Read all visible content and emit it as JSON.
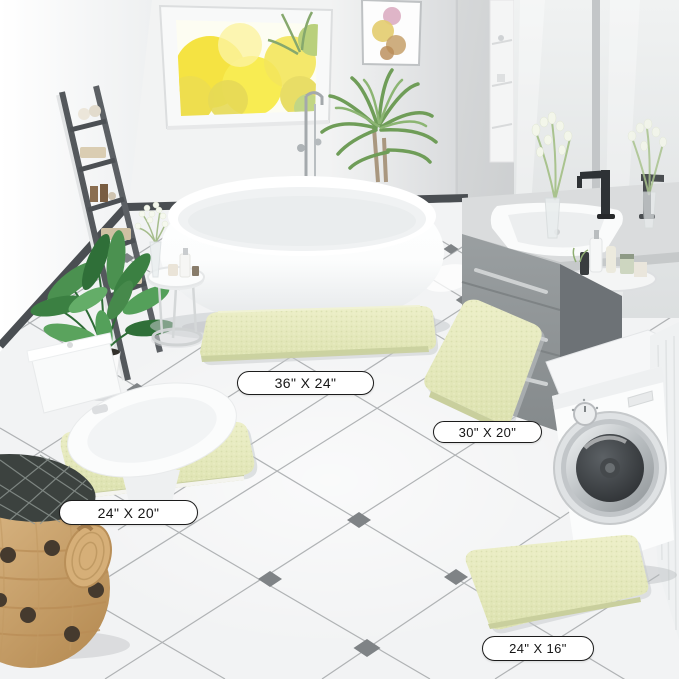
{
  "rugs": [
    {
      "name": "bath-rug-large",
      "size_label": "36\" X 24\""
    },
    {
      "name": "bath-rug-medium",
      "size_label": "30\" X 20\""
    },
    {
      "name": "bath-rug-contour",
      "size_label": "24\" X 20\""
    },
    {
      "name": "bath-rug-small",
      "size_label": "24\" X 16\""
    }
  ],
  "colors": {
    "rug": "#e4e8bf",
    "rug_edge": "#c9cf9d",
    "floor": "#f2f3f4",
    "floor_tile_line": "#a9acae",
    "floor_diamond": "#7f8386",
    "wall_left": "#fbfcfd",
    "wall_back": "#f2f3f3",
    "wall_right": "#c3c6c8",
    "baseboard": "#4a4e52",
    "ladder": "#54585c",
    "vanity": "#8f9496",
    "foliage": "#4b9150",
    "window_foliage": "#f4e238",
    "basket": "#cfa369",
    "label_border": "#1c1c1c",
    "label_bg": "#ffffff",
    "label_text": "#161616"
  }
}
